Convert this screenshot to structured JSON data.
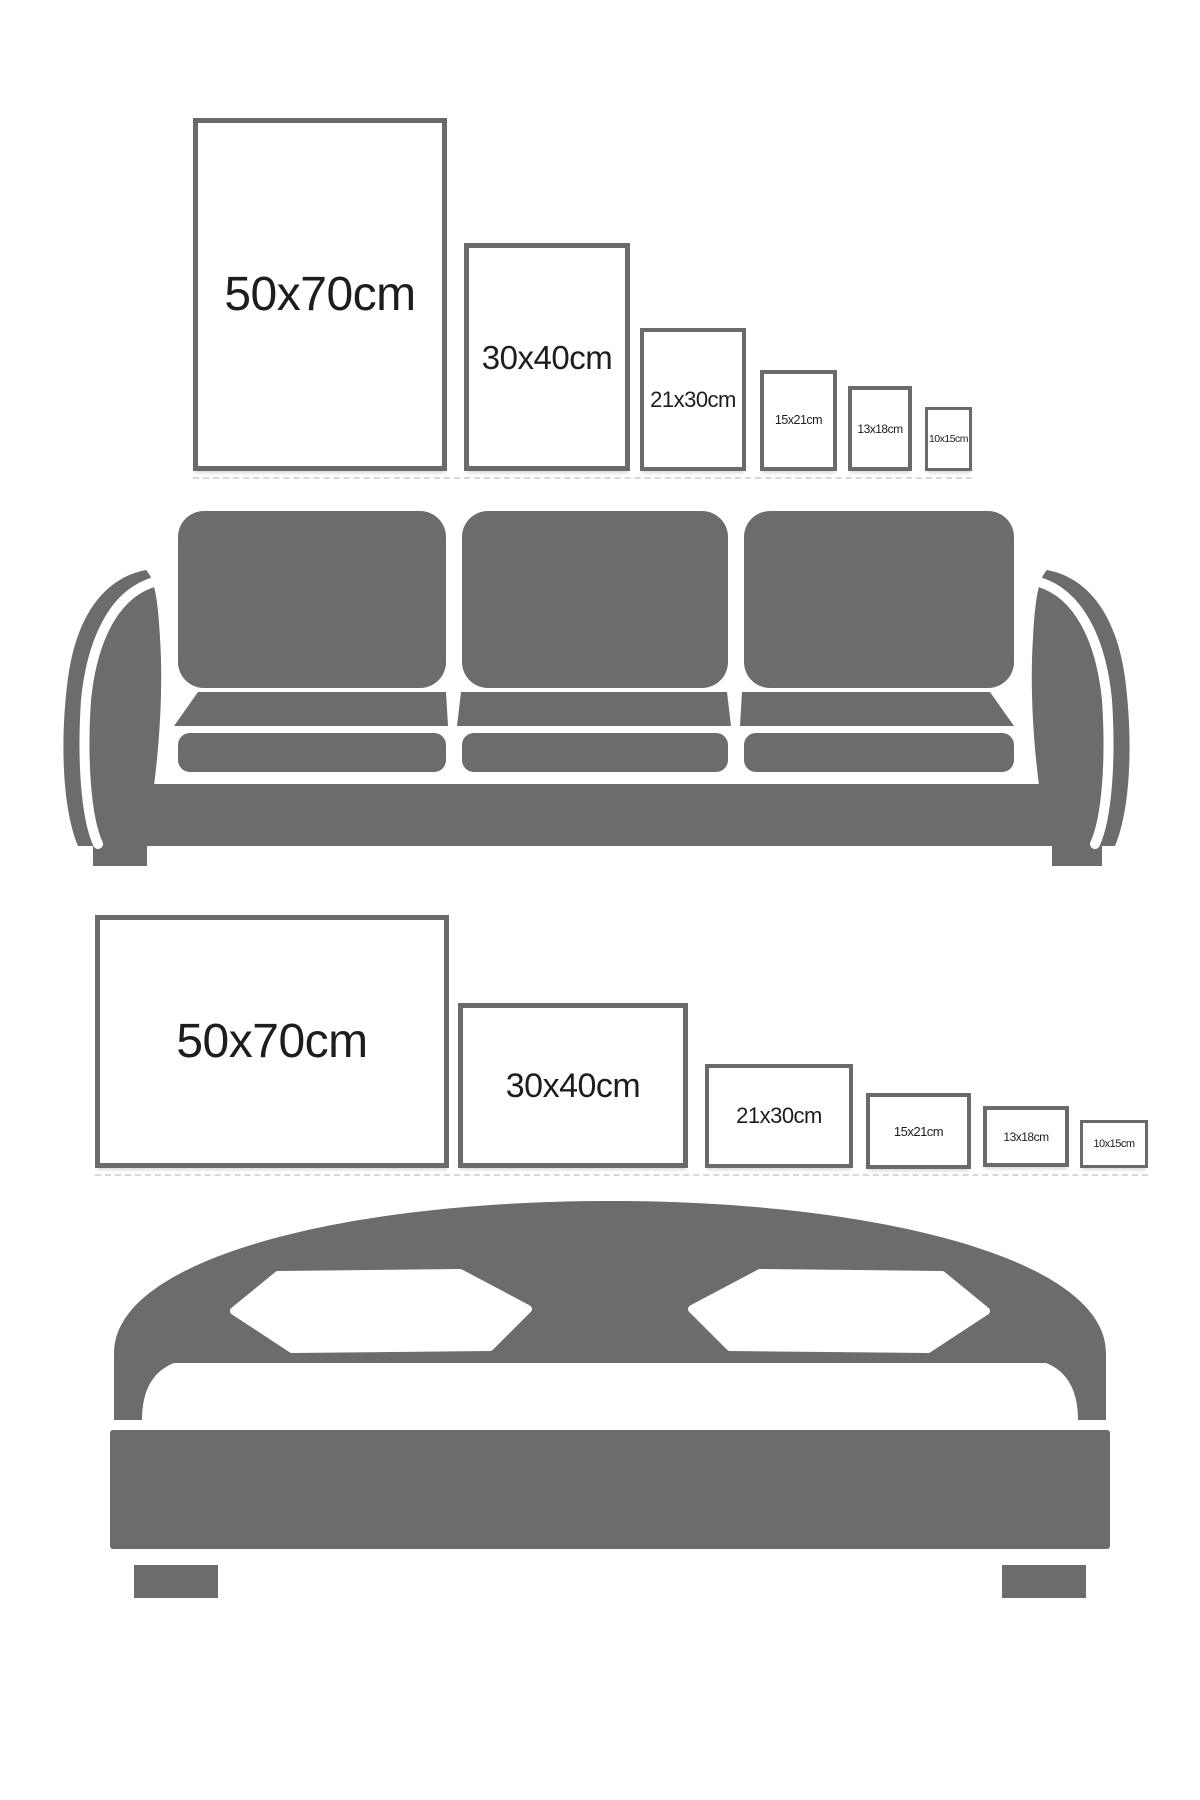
{
  "colors": {
    "background": "#ffffff",
    "furniture_gray": "#6c6c6c",
    "frame_border": "#6a6a6a",
    "label_text": "#1d1d1d"
  },
  "rows": [
    {
      "id": "portrait",
      "orientation": "portrait",
      "furniture": "sofa",
      "frames": [
        {
          "label": "50x70cm",
          "w_cm": 50,
          "h_cm": 70,
          "box": {
            "left": 193,
            "top": 118,
            "width": 254,
            "height": 353
          },
          "font": 48,
          "border": 5
        },
        {
          "label": "30x40cm",
          "w_cm": 30,
          "h_cm": 40,
          "box": {
            "left": 464,
            "top": 243,
            "width": 166,
            "height": 228
          },
          "font": 33,
          "border": 5
        },
        {
          "label": "21x30cm",
          "w_cm": 21,
          "h_cm": 30,
          "box": {
            "left": 640,
            "top": 328,
            "width": 106,
            "height": 143
          },
          "font": 22,
          "border": 4
        },
        {
          "label": "15x21cm",
          "w_cm": 15,
          "h_cm": 21,
          "box": {
            "left": 760,
            "top": 370,
            "width": 77,
            "height": 101
          },
          "font": 12.5,
          "border": 4
        },
        {
          "label": "13x18cm",
          "w_cm": 13,
          "h_cm": 18,
          "box": {
            "left": 848,
            "top": 386,
            "width": 64,
            "height": 85
          },
          "font": 12,
          "border": 4
        },
        {
          "label": "10x15cm",
          "w_cm": 10,
          "h_cm": 15,
          "box": {
            "left": 925,
            "top": 407,
            "width": 47,
            "height": 64
          },
          "font": 10.5,
          "border": 3
        }
      ]
    },
    {
      "id": "landscape",
      "orientation": "landscape",
      "furniture": "bed",
      "frames": [
        {
          "label": "50x70cm",
          "w_cm": 70,
          "h_cm": 50,
          "box": {
            "left": 95,
            "top": 915,
            "width": 354,
            "height": 253
          },
          "font": 48,
          "border": 5
        },
        {
          "label": "30x40cm",
          "w_cm": 40,
          "h_cm": 30,
          "box": {
            "left": 458,
            "top": 1003,
            "width": 230,
            "height": 165
          },
          "font": 34,
          "border": 5
        },
        {
          "label": "21x30cm",
          "w_cm": 30,
          "h_cm": 21,
          "box": {
            "left": 705,
            "top": 1064,
            "width": 148,
            "height": 104
          },
          "font": 22,
          "border": 4
        },
        {
          "label": "15x21cm",
          "w_cm": 21,
          "h_cm": 15,
          "box": {
            "left": 866,
            "top": 1093,
            "width": 105,
            "height": 76
          },
          "font": 13,
          "border": 4
        },
        {
          "label": "13x18cm",
          "w_cm": 18,
          "h_cm": 13,
          "box": {
            "left": 983,
            "top": 1106,
            "width": 86,
            "height": 61
          },
          "font": 12,
          "border": 4
        },
        {
          "label": "10x15cm",
          "w_cm": 15,
          "h_cm": 10,
          "box": {
            "left": 1080,
            "top": 1120,
            "width": 68,
            "height": 48
          },
          "font": 11,
          "border": 3
        }
      ]
    }
  ]
}
